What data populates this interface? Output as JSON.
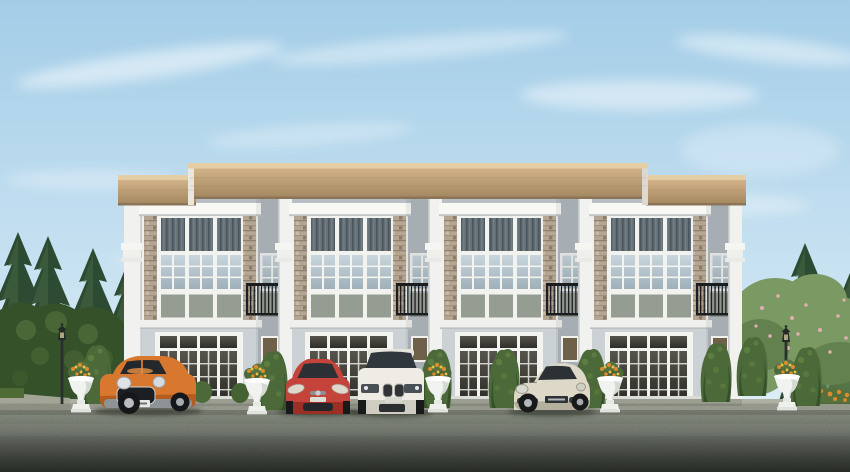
{
  "palette": {
    "sky_top": "#a3cde7",
    "sky_mid": "#c6e1f1",
    "sky_horizon": "#e9f3f8",
    "cloud": "#ffffff",
    "roof_fascia": "#e5cda6",
    "roof_wood_light": "#d2b289",
    "roof_wood_dark": "#a2865e",
    "roof_lip": "#8c7458",
    "wall_white": "#f0f0ec",
    "cornice": "#f8f8f5",
    "parapet_gray": "#b9c0c5",
    "recess_gray": "#b2b9bf",
    "ground_wall": "#cbd1d4",
    "skirting": "#d9dcd7",
    "curtain": "#646e75",
    "curtain_stripe": "#4c565d",
    "glass_top": "#c9d6dd",
    "glass_bottom": "#9fb0ba",
    "spandrel": "#959c91",
    "brick_base": "#b5a694",
    "brick_course": "#90816f",
    "door_glass_top": "#56544c",
    "door_glass_bottom": "#2e2d27",
    "accent_window_amber": "#6f6049",
    "balcony_iron": "#1b1e20",
    "conifer_dark": "#2d4b33",
    "conifer_light": "#456741",
    "tree_green": "#7b9a63",
    "tree_green_dark": "#5c7c4a",
    "blossom_pink": "#e2aeb2",
    "hedge": "#4c6a39",
    "hedge_dark": "#35512a",
    "hedge_light": "#628344",
    "grass": "#4e6b35",
    "flower_orange": "#dd8c2e",
    "flower_yellow": "#e9c04a",
    "urn_white": "#f1f3f0",
    "walkway": "#adb0a2",
    "driveway_top": "#9aa092",
    "driveway_mid": "#7d8378",
    "driveway_bottom": "#41473f",
    "lamp_post": "#2a302e"
  },
  "scene": {
    "building": {
      "kind": "two-story-townhouse-row",
      "units": 4,
      "window_strips_per_bay": 3,
      "balconies": 4,
      "planters": 5,
      "street_lamps": 2
    },
    "cars": [
      {
        "name": "orange-mini-hatchback",
        "color": "#d8782f",
        "color_dark": "#b55c1f"
      },
      {
        "name": "red-compact-hatchback",
        "color": "#c4433a",
        "color_dark": "#9c2f24"
      },
      {
        "name": "white-luxury-suv",
        "color": "#eeece4",
        "color_dark": "#cfccc2"
      },
      {
        "name": "champagne-sports-sedan",
        "color": "#ddd8c8",
        "color_dark": "#b5af9e"
      }
    ]
  }
}
